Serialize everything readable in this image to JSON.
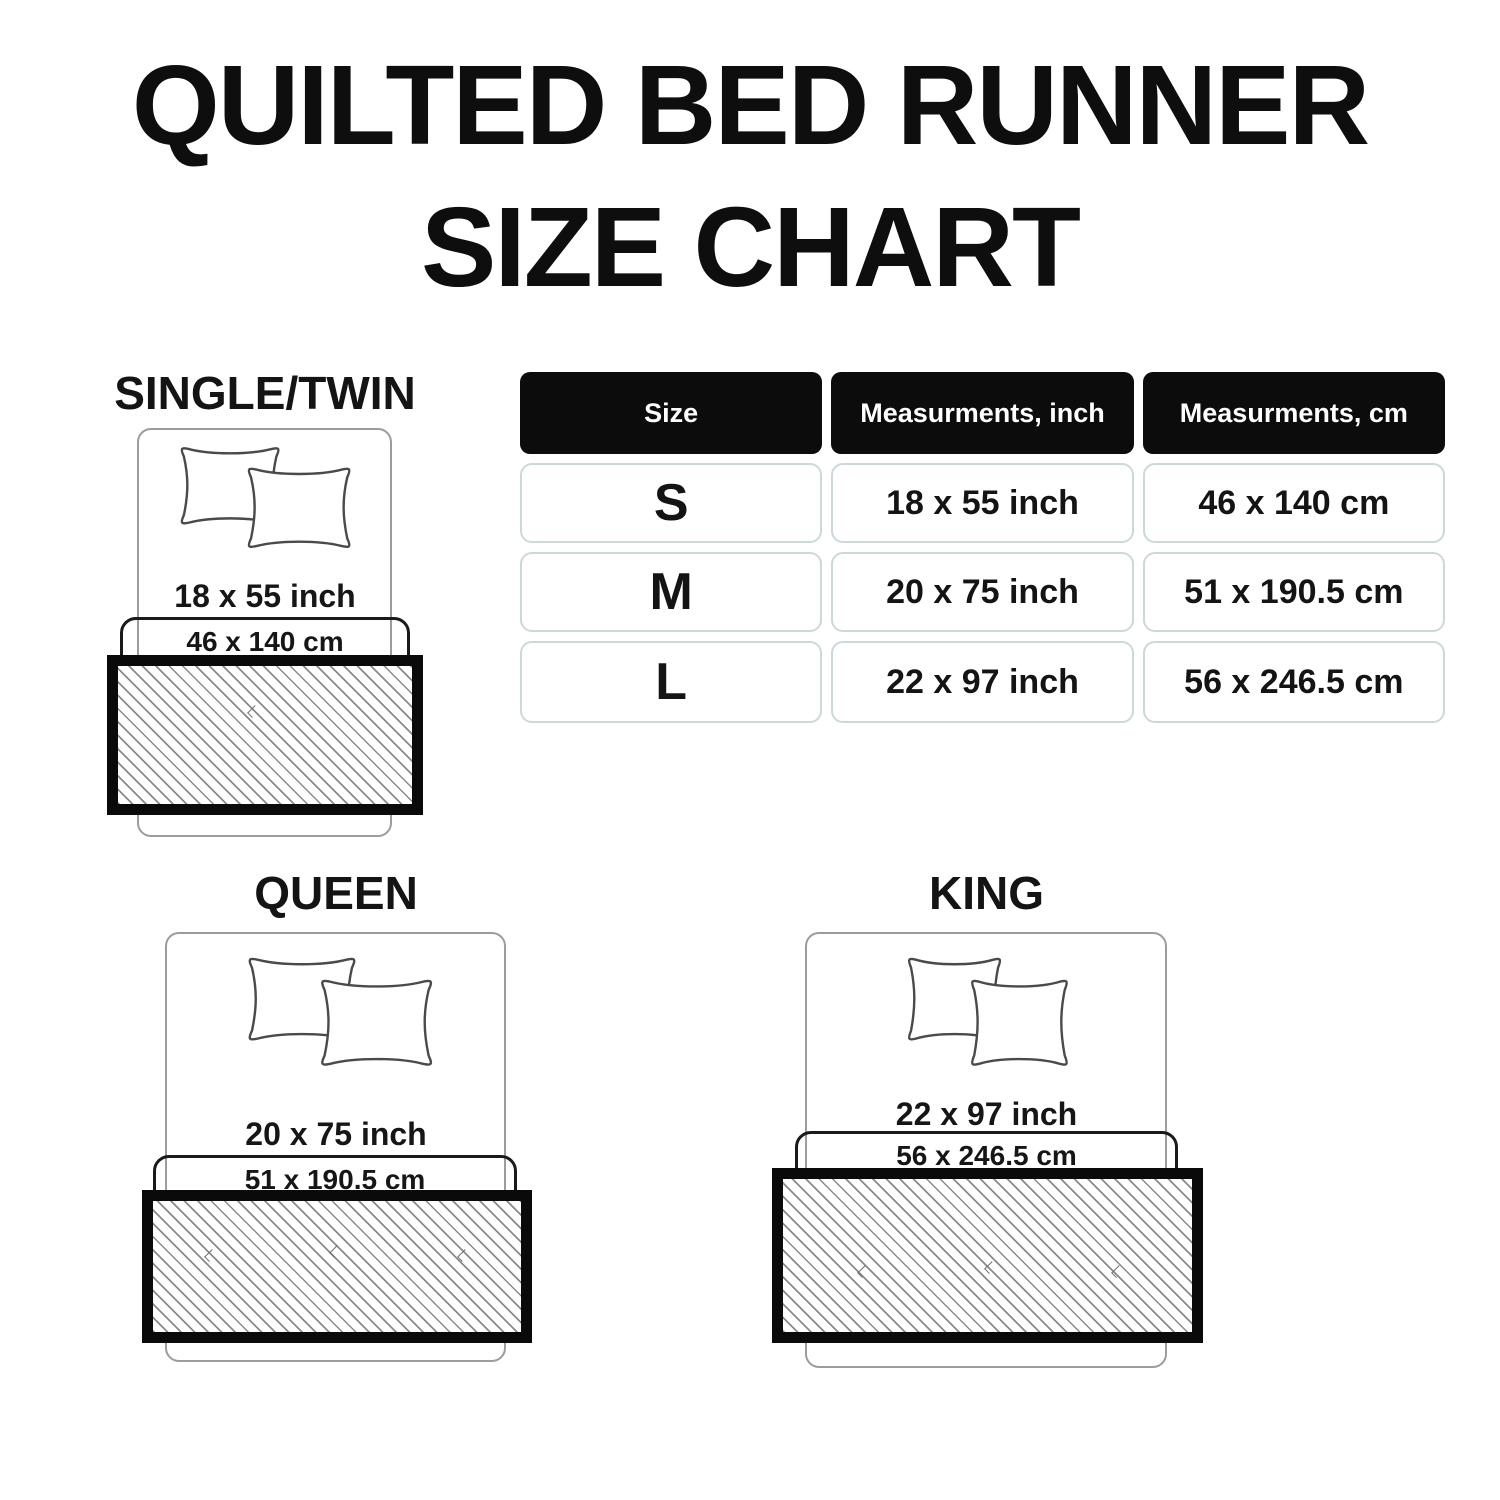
{
  "title": {
    "line1": "QUILTED BED RUNNER",
    "line2": "SIZE CHART"
  },
  "table": {
    "headers": [
      "Size",
      "Measurments, inch",
      "Measurments, cm"
    ],
    "rows": [
      {
        "size": "S",
        "inch": "18 x 55 inch",
        "cm": "46 x 140 cm"
      },
      {
        "size": "M",
        "inch": "20 x 75 inch",
        "cm": "51 x 190.5 cm"
      },
      {
        "size": "L",
        "inch": "22 x 97 inch",
        "cm": "56 x 246.5 cm"
      }
    ]
  },
  "diagrams": [
    {
      "name": "SINGLE/TWIN",
      "inch": "18 x 55 inch",
      "cm": "46 x 140 cm"
    },
    {
      "name": "QUEEN",
      "inch": "20 x 75 inch",
      "cm": "51 x 190.5 cm"
    },
    {
      "name": "KING",
      "inch": "22 x 97 inch",
      "cm": "56 x 246.5 cm"
    }
  ],
  "colors": {
    "background": "#ffffff",
    "text": "#121212",
    "table_header_bg": "#0c0c0c",
    "table_header_text": "#ffffff",
    "table_cell_border": "#ccd8da",
    "bed_outline": "#9c9c9c",
    "runner_border": "#0a0a0a",
    "hatch_line": "#8a8a8a"
  },
  "chart_data": {
    "type": "table",
    "title": "QUILTED BED RUNNER SIZE CHART",
    "columns": [
      "Size",
      "Measurments, inch",
      "Measurments, cm"
    ],
    "rows": [
      [
        "S",
        "18 x 55 inch",
        "46 x 140 cm"
      ],
      [
        "M",
        "20 x 75 inch",
        "51 x 190.5 cm"
      ],
      [
        "L",
        "22 x 97 inch",
        "56 x 246.5 cm"
      ]
    ],
    "bed_mappings": [
      {
        "bed": "SINGLE/TWIN",
        "runner_inch": [
          18,
          55
        ],
        "runner_cm": [
          46,
          140
        ]
      },
      {
        "bed": "QUEEN",
        "runner_inch": [
          20,
          75
        ],
        "runner_cm": [
          51,
          190.5
        ]
      },
      {
        "bed": "KING",
        "runner_inch": [
          22,
          97
        ],
        "runner_cm": [
          56,
          246.5
        ]
      }
    ]
  }
}
